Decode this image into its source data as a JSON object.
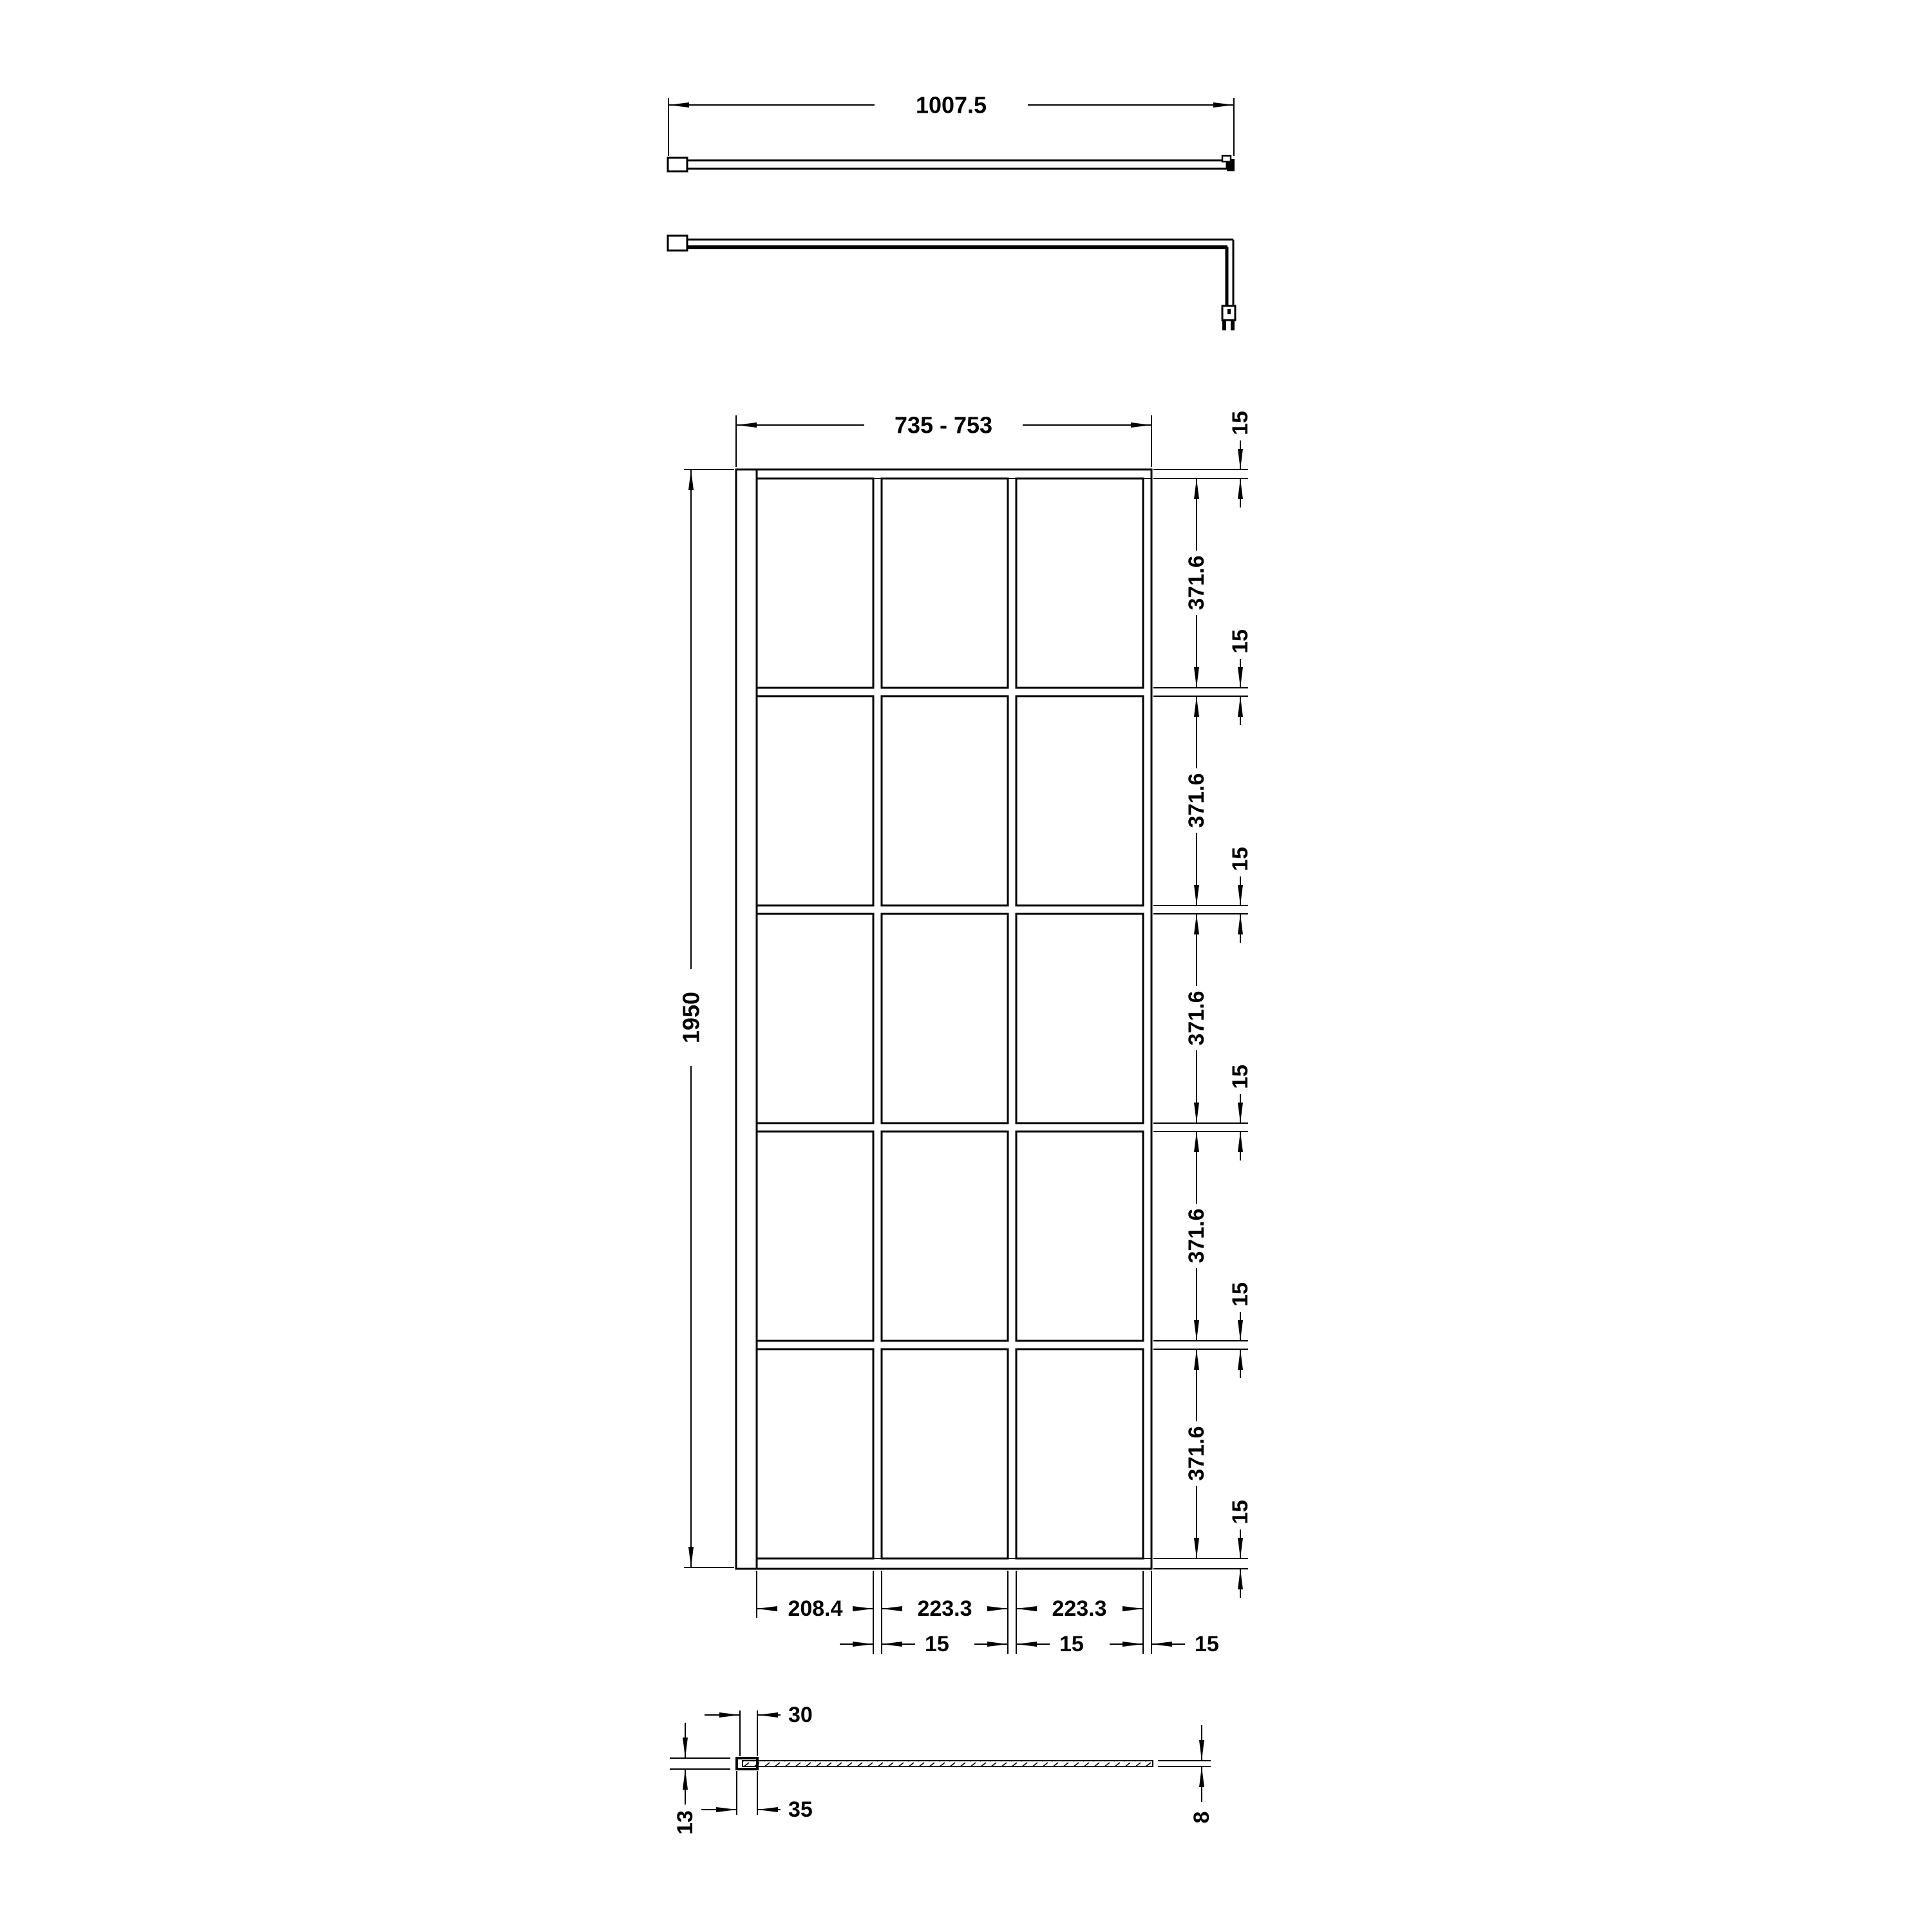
{
  "background": "#ffffff",
  "ink": "#000000",
  "views": {
    "bar_front": {
      "length": "1007.5"
    },
    "elevation": {
      "overall_width": "735 - 753",
      "overall_height": "1950",
      "pane_heights": [
        "371.6",
        "371.6",
        "371.6",
        "371.6",
        "371.6"
      ],
      "rail_thicknesses": [
        "15",
        "15",
        "15",
        "15",
        "15",
        "15"
      ],
      "pane_widths": [
        "208.4",
        "223.3",
        "223.3"
      ],
      "mullion_widths": [
        "15",
        "15",
        "15"
      ]
    },
    "profile": {
      "wall_channel_inner_width": "30",
      "wall_channel_outer_width": "35",
      "wall_channel_depth": "13",
      "glass_thickness": "8"
    }
  }
}
